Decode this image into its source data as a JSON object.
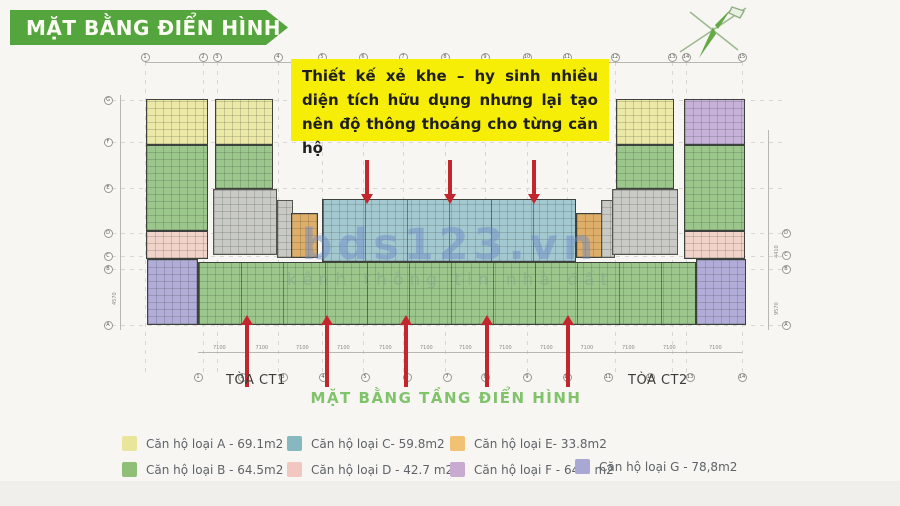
{
  "banner": {
    "title": "MẶT BẰNG ĐIỂN HÌNH",
    "color": "#54a53d"
  },
  "callout": {
    "text": "Thiết kế xẻ khe – hy sinh nhiều diện tích hữu dụng nhưng lại tạo nên độ thông thoáng cho từng căn hộ",
    "bg": "#f6ee06"
  },
  "watermark": {
    "brand": "bds123.vn",
    "tagline": "kênh thông tin nhà đất"
  },
  "plan": {
    "tower1_label": "TÒA CT1",
    "tower2_label": "TÒA CT2",
    "caption": "MẶT BẰNG TẦNG ĐIỂN HÌNH",
    "dim_label": "7100",
    "dim_left": "4570",
    "dim_right_1": "4410",
    "dim_right_2": "9570",
    "arrow_color": "#c1272d",
    "colors": {
      "A": "#ece8a6",
      "B": "#9cc78c",
      "C": "#a3c8cf",
      "D": "#f2d3c9",
      "E": "#dfae68",
      "F": "#c7b2da",
      "G": "#b1add8",
      "core": "#c9c9c5"
    },
    "grid_top": [
      {
        "x": 145,
        "n": "1"
      },
      {
        "x": 203,
        "n": "2"
      },
      {
        "x": 217,
        "n": "3"
      },
      {
        "x": 278,
        "n": "4"
      },
      {
        "x": 322,
        "n": "5"
      },
      {
        "x": 363,
        "n": "6"
      },
      {
        "x": 403,
        "n": "7"
      },
      {
        "x": 445,
        "n": "8"
      },
      {
        "x": 485,
        "n": "9"
      },
      {
        "x": 527,
        "n": "10"
      },
      {
        "x": 567,
        "n": "11"
      },
      {
        "x": 615,
        "n": "12"
      },
      {
        "x": 672,
        "n": "13"
      },
      {
        "x": 686,
        "n": "14"
      },
      {
        "x": 742,
        "n": "15"
      }
    ],
    "grid_bottom": [
      {
        "x": 198,
        "n": "1"
      },
      {
        "x": 242,
        "n": "2"
      },
      {
        "x": 283,
        "n": "3"
      },
      {
        "x": 323,
        "n": "4"
      },
      {
        "x": 365,
        "n": "5"
      },
      {
        "x": 407,
        "n": "6"
      },
      {
        "x": 447,
        "n": "7"
      },
      {
        "x": 485,
        "n": "8"
      },
      {
        "x": 527,
        "n": "9"
      },
      {
        "x": 567,
        "n": "10"
      },
      {
        "x": 608,
        "n": "11"
      },
      {
        "x": 650,
        "n": "12"
      },
      {
        "x": 690,
        "n": "13"
      },
      {
        "x": 742,
        "n": "14"
      }
    ],
    "grid_left": [
      {
        "y": 100,
        "l": "G"
      },
      {
        "y": 142,
        "l": "F"
      },
      {
        "y": 188,
        "l": "E"
      },
      {
        "y": 233,
        "l": "D"
      },
      {
        "y": 256,
        "l": "C"
      },
      {
        "y": 269,
        "l": "B"
      },
      {
        "y": 325,
        "l": "A"
      }
    ],
    "grid_right": [
      {
        "y": 233,
        "l": "D"
      },
      {
        "y": 255,
        "l": "C"
      },
      {
        "y": 269,
        "l": "B"
      },
      {
        "y": 325,
        "l": "A"
      }
    ],
    "blocks": [
      {
        "x": 146,
        "y": 99,
        "w": 62,
        "h": 46,
        "t": "A"
      },
      {
        "x": 215,
        "y": 99,
        "w": 58,
        "h": 46,
        "t": "A"
      },
      {
        "x": 146,
        "y": 145,
        "w": 62,
        "h": 86,
        "t": "B"
      },
      {
        "x": 215,
        "y": 145,
        "w": 58,
        "h": 44,
        "t": "B"
      },
      {
        "x": 213,
        "y": 189,
        "w": 64,
        "h": 66,
        "t": "core"
      },
      {
        "x": 146,
        "y": 231,
        "w": 62,
        "h": 28,
        "t": "D"
      },
      {
        "x": 277,
        "y": 200,
        "w": 16,
        "h": 58,
        "t": "core"
      },
      {
        "x": 291,
        "y": 213,
        "w": 27,
        "h": 45,
        "t": "E"
      },
      {
        "x": 322,
        "y": 199,
        "w": 254,
        "h": 63,
        "t": "C",
        "band": true
      },
      {
        "x": 576,
        "y": 213,
        "w": 27,
        "h": 45,
        "t": "E"
      },
      {
        "x": 601,
        "y": 200,
        "w": 14,
        "h": 58,
        "t": "core"
      },
      {
        "x": 147,
        "y": 259,
        "w": 51,
        "h": 66,
        "t": "G"
      },
      {
        "x": 198,
        "y": 262,
        "w": 498,
        "h": 63,
        "t": "B",
        "band": true
      },
      {
        "x": 696,
        "y": 259,
        "w": 50,
        "h": 66,
        "t": "G"
      },
      {
        "x": 616,
        "y": 99,
        "w": 58,
        "h": 46,
        "t": "A"
      },
      {
        "x": 684,
        "y": 99,
        "w": 61,
        "h": 46,
        "t": "F"
      },
      {
        "x": 616,
        "y": 145,
        "w": 58,
        "h": 44,
        "t": "B"
      },
      {
        "x": 684,
        "y": 145,
        "w": 61,
        "h": 86,
        "t": "B"
      },
      {
        "x": 612,
        "y": 189,
        "w": 66,
        "h": 66,
        "t": "core"
      },
      {
        "x": 684,
        "y": 231,
        "w": 61,
        "h": 28,
        "t": "D"
      }
    ],
    "arrows_down": [
      367,
      450,
      534
    ],
    "arrows_up": [
      247,
      327,
      406,
      487,
      568
    ]
  },
  "legend": {
    "items": [
      {
        "letter": "A",
        "label": "Căn hộ loại A - 69.1m2",
        "color": "#e9e59a",
        "x": 122,
        "y": 436
      },
      {
        "letter": "C",
        "label": "Căn hộ loại C- 59.8m2",
        "color": "#87b7bf",
        "x": 287,
        "y": 436
      },
      {
        "letter": "E",
        "label": "Căn hộ loại E- 33.8m2",
        "color": "#f2c173",
        "x": 450,
        "y": 436
      },
      {
        "letter": "B",
        "label": "Căn hộ loại B - 64.5m2",
        "color": "#90bf78",
        "x": 122,
        "y": 462
      },
      {
        "letter": "D",
        "label": "Căn hộ loại D - 42.7 m2",
        "color": "#f2c7bf",
        "x": 287,
        "y": 462
      },
      {
        "letter": "F",
        "label": "Căn hộ loại F - 64.2 m2",
        "color": "#c9abd2",
        "x": 450,
        "y": 462
      },
      {
        "letter": "G",
        "label": "Căn hộ loại G - 78,8m2",
        "color": "#a9a7d4",
        "x": 575,
        "y": 459
      }
    ]
  }
}
